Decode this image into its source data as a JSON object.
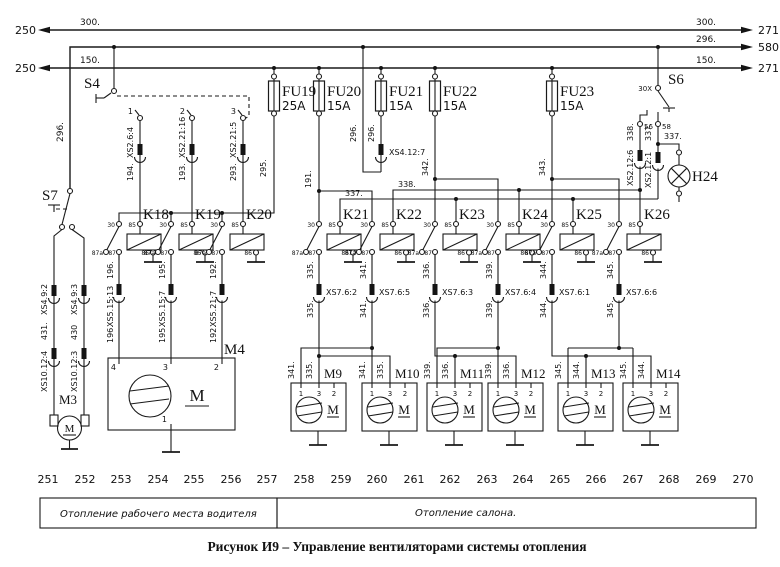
{
  "caption": "Рисунок И9 – Управление вентиляторами системы отопления",
  "buses": {
    "b300": {
      "num_left": "250",
      "wire_left": "300.",
      "wire_right": "300.",
      "num_right": "271"
    },
    "b296": {
      "wire_right": "296.",
      "num_right": "580",
      "drop_wire": "296."
    },
    "b150": {
      "num_left": "250",
      "wire_left": "150.",
      "wire_right": "150.",
      "num_right": "271"
    }
  },
  "fuses": [
    {
      "name": "FU19",
      "rating": "25A"
    },
    {
      "name": "FU20",
      "rating": "15A"
    },
    {
      "name": "FU21",
      "rating": "15A"
    },
    {
      "name": "FU22",
      "rating": "15A"
    },
    {
      "name": "FU23",
      "rating": "15A"
    }
  ],
  "s4": {
    "name": "S4",
    "c1": "1",
    "c2": "2",
    "c3": "3",
    "out": [
      {
        "conn": "XS2.6:4",
        "wire": "194."
      },
      {
        "conn": "XS2.21:16",
        "wire": "193."
      },
      {
        "conn": "XS2.21:5",
        "wire": "293."
      }
    ]
  },
  "s6": {
    "name": "S6",
    "t": "30X",
    "c56": "56",
    "c58": "58",
    "w56": "338.",
    "conn56": "XS2.12:6",
    "w58": "337.",
    "conn58": "XS2.12:1",
    "branch": "337."
  },
  "s7": {
    "name": "S7",
    "left": {
      "conn1": "XS4.9:2",
      "wire": "431.",
      "conn2": "XS10.12:4"
    },
    "right": {
      "conn1": "XS4.9:3",
      "wire": "430",
      "conn2": "XS10.12:3"
    }
  },
  "lamp": {
    "name": "H24"
  },
  "link": {
    "w295": "295.",
    "w191": "191.",
    "w296a": "296.",
    "w296b": "296.",
    "conn296": "XS4.12:7",
    "w342": "342.",
    "w343": "343.",
    "w337": "337.",
    "w338": "338."
  },
  "relay_terms": {
    "t30": "30",
    "t85": "85",
    "t87a": "87a",
    "t87": "87",
    "t86": "86"
  },
  "relays": [
    {
      "name": "K18",
      "wire": "196.",
      "conn": "XS5.15:13"
    },
    {
      "name": "K19",
      "wire": "195.",
      "conn": "XS5.15:7"
    },
    {
      "name": "K20",
      "wire": "192.",
      "conn": "XS5.21:7"
    },
    {
      "name": "K21",
      "wire": "335.",
      "conn": "XS7.6:2"
    },
    {
      "name": "K22",
      "wire": "341.",
      "conn": "XS7.6:5"
    },
    {
      "name": "K23",
      "wire": "336.",
      "conn": "XS7.6:3"
    },
    {
      "name": "K24",
      "wire": "339.",
      "conn": "XS7.6:4"
    },
    {
      "name": "K25",
      "wire": "344.",
      "conn": "XS7.6:1"
    },
    {
      "name": "K26",
      "wire": "345.",
      "conn": "XS7.6:6"
    }
  ],
  "m3": {
    "name": "M3",
    "letter": "M"
  },
  "m4": {
    "name": "M4",
    "letter": "M",
    "t4": "4",
    "t3": "3",
    "t2": "2",
    "t1": "1"
  },
  "fans": [
    {
      "name": "M9",
      "w1": "341.",
      "w3": "335.",
      "t1": "1",
      "t3": "3",
      "t2": "2",
      "letter": "M"
    },
    {
      "name": "M10",
      "w1": "341.",
      "w3": "335.",
      "t1": "1",
      "t3": "3",
      "t2": "2",
      "letter": "M"
    },
    {
      "name": "M11",
      "w1": "339.",
      "w3": "336.",
      "t1": "1",
      "t3": "3",
      "t2": "2",
      "letter": "M"
    },
    {
      "name": "M12",
      "w1": "339.",
      "w3": "336.",
      "t1": "1",
      "t3": "3",
      "t2": "2",
      "letter": "M"
    },
    {
      "name": "M13",
      "w1": "345.",
      "w3": "344.",
      "t1": "1",
      "t3": "3",
      "t2": "2",
      "letter": "M"
    },
    {
      "name": "M14",
      "w1": "345.",
      "w3": "344.",
      "t1": "1",
      "t3": "3",
      "t2": "2",
      "letter": "M"
    }
  ],
  "scale": [
    "251",
    "252",
    "253",
    "254",
    "255",
    "256",
    "257",
    "258",
    "259",
    "260",
    "261",
    "262",
    "263",
    "264",
    "265",
    "266",
    "267",
    "268",
    "269",
    "270"
  ],
  "zones": {
    "left": "Отопление рабочего места водителя",
    "right": "Отопление салона."
  }
}
